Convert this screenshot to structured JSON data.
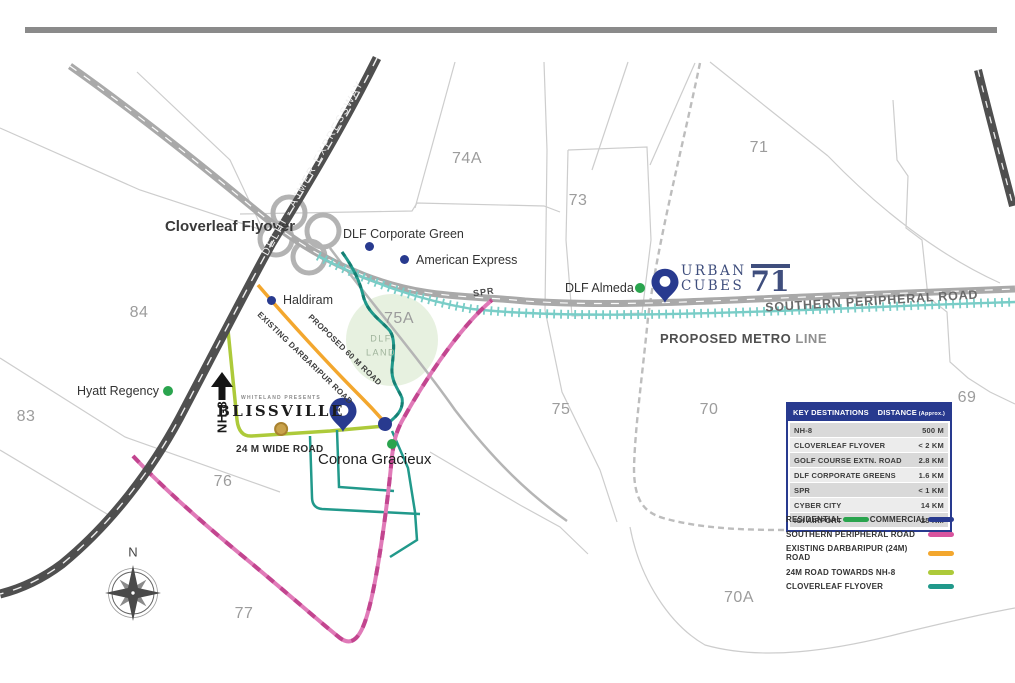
{
  "page": {
    "top_bar_color": "#8a8a8a"
  },
  "compass": {
    "north": "N"
  },
  "sectors": {
    "s74a": "74A",
    "s73": "73",
    "s71": "71",
    "s84": "84",
    "s75a": "75A",
    "s75": "75",
    "s70": "70",
    "s69": "69",
    "s83": "83",
    "s76": "76",
    "s77": "77",
    "s70a": "70A"
  },
  "landmarks": {
    "dlf_corporate_green": "DLF Corporate Green",
    "american_express": "American Express",
    "haldiram": "Haldiram",
    "hyatt_regency": "Hyatt Regency",
    "dlf_almeda": "DLF Almeda",
    "corona_gracieux": "Corona Gracieux"
  },
  "roads": {
    "cloverleaf_flyover": "Cloverleaf Flyover",
    "delhi_ajmer": "DELHI - AJMER EXPRESSWAY",
    "southern_peripheral": "SOUTHERN PERIPHERAL ROAD",
    "proposed_metro_bold": "PROPOSED METRO",
    "proposed_metro_light": "LINE",
    "spr_short": "SPR",
    "nh8": "NH-8",
    "wide_road_24m": "24 M WIDE ROAD",
    "existing_darbaripur": "EXISTING DARBARIPUR ROAD",
    "proposed_60m": "PROPOSED 60 M ROAD"
  },
  "projects": {
    "blissville": {
      "presents": "WHITELAND PRESENTS",
      "name": "BLISSVILLE"
    },
    "urban_cubes": {
      "line1": "URBAN",
      "line2": "CUBES",
      "number": "71"
    }
  },
  "dlf_land": {
    "line1": "DLF",
    "line2": "LAND"
  },
  "table": {
    "headers": {
      "destination": "KEY DESTINATIONS",
      "distance": "DISTANCE",
      "distance_note": "(Approx.)"
    },
    "rows": [
      {
        "name": "NH-8",
        "distance": "500 M"
      },
      {
        "name": "CLOVERLEAF FLYOVER",
        "distance": "< 2 KM"
      },
      {
        "name": "GOLF COURSE EXTN. ROAD",
        "distance": "2.8 KM"
      },
      {
        "name": "DLF CORPORATE GREENS",
        "distance": "1.6 KM"
      },
      {
        "name": "SPR",
        "distance": "< 1 KM"
      },
      {
        "name": "CYBER CITY",
        "distance": "14 KM"
      },
      {
        "name": "IGI AIRPORT",
        "distance": "25 KM"
      }
    ]
  },
  "legend": {
    "residential": {
      "label": "RESIDENTIAL",
      "color": "#2aa44e"
    },
    "commercial": {
      "label": "COMMERCIAL",
      "color": "#283a8f"
    },
    "items": [
      {
        "label": "SOUTHERN PERIPHERAL ROAD",
        "color": "#d8549e"
      },
      {
        "label": "EXISTING DARBARIPUR (24M) ROAD",
        "color": "#f3a72e"
      },
      {
        "label": "24M ROAD TOWARDS NH-8",
        "color": "#adca3a"
      },
      {
        "label": "CLOVERLEAF FLYOVER",
        "color": "#21998b"
      }
    ]
  }
}
